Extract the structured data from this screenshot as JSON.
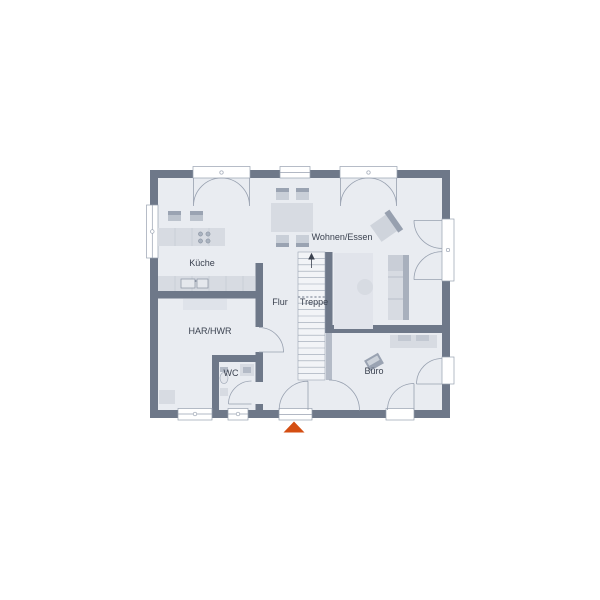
{
  "floorplan": {
    "type": "ground-floor-plan",
    "rooms": [
      {
        "id": "kueche",
        "label": "Küche"
      },
      {
        "id": "wohnen-essen",
        "label": "Wohnen/Essen"
      },
      {
        "id": "flur",
        "label": "Flur"
      },
      {
        "id": "treppe",
        "label": "Treppe"
      },
      {
        "id": "har-hwr",
        "label": "HAR/HWR"
      },
      {
        "id": "wc",
        "label": "WC"
      },
      {
        "id": "buero",
        "label": "Büro"
      }
    ],
    "colors": {
      "background": "#ffffff",
      "wall": "#6e7889",
      "floor": "#e9ecf1",
      "stair_fill": "#f2f4f7",
      "furniture": "#d7dbe2",
      "furniture_dark": "#9aa3b2",
      "outline": "#98a1b0",
      "label": "#3b4250",
      "entrance_marker": "#d44e12"
    },
    "markers": {
      "entrance": "triangle-up",
      "stair_direction": "arrow-up"
    }
  }
}
